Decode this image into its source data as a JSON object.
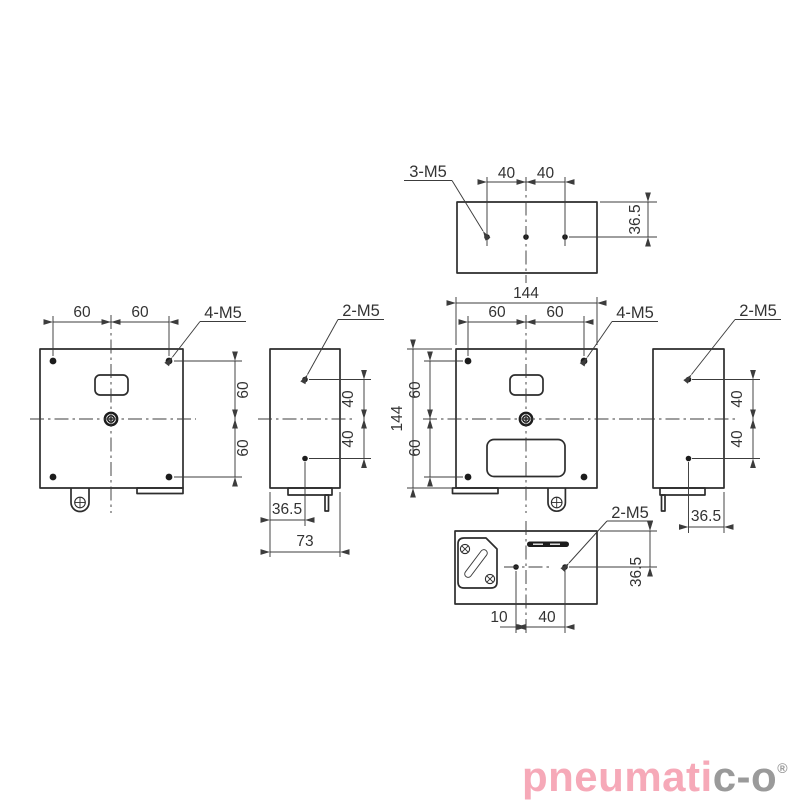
{
  "views": {
    "top": {
      "thread": "3-M5",
      "dim_spacing": "40",
      "dim_offset": "36.5"
    },
    "front": {
      "thread": "4-M5",
      "dim_spacing": "60"
    },
    "left_side": {
      "thread": "2-M5",
      "dim_spacing": "40",
      "dim_offset": "36.5",
      "dim_width": "73"
    },
    "back": {
      "thread": "4-M5",
      "dim_spacing": "60",
      "dim_width": "144",
      "dim_height": "144"
    },
    "right_side": {
      "thread": "2-M5",
      "dim_spacing": "40",
      "dim_offset": "36.5"
    },
    "bottom": {
      "thread": "2-M5",
      "dim_10": "10",
      "dim_40": "40",
      "dim_offset": "36.5"
    }
  },
  "logo": {
    "primary": "pneumati",
    "secondary": "c-o",
    "registered": "®",
    "primary_color": "#f6a9b8",
    "secondary_color": "#9a9a9a"
  },
  "style": {
    "line_color": "#2d2d2d",
    "thin_color": "#3c3c3c",
    "background": "#ffffff"
  }
}
